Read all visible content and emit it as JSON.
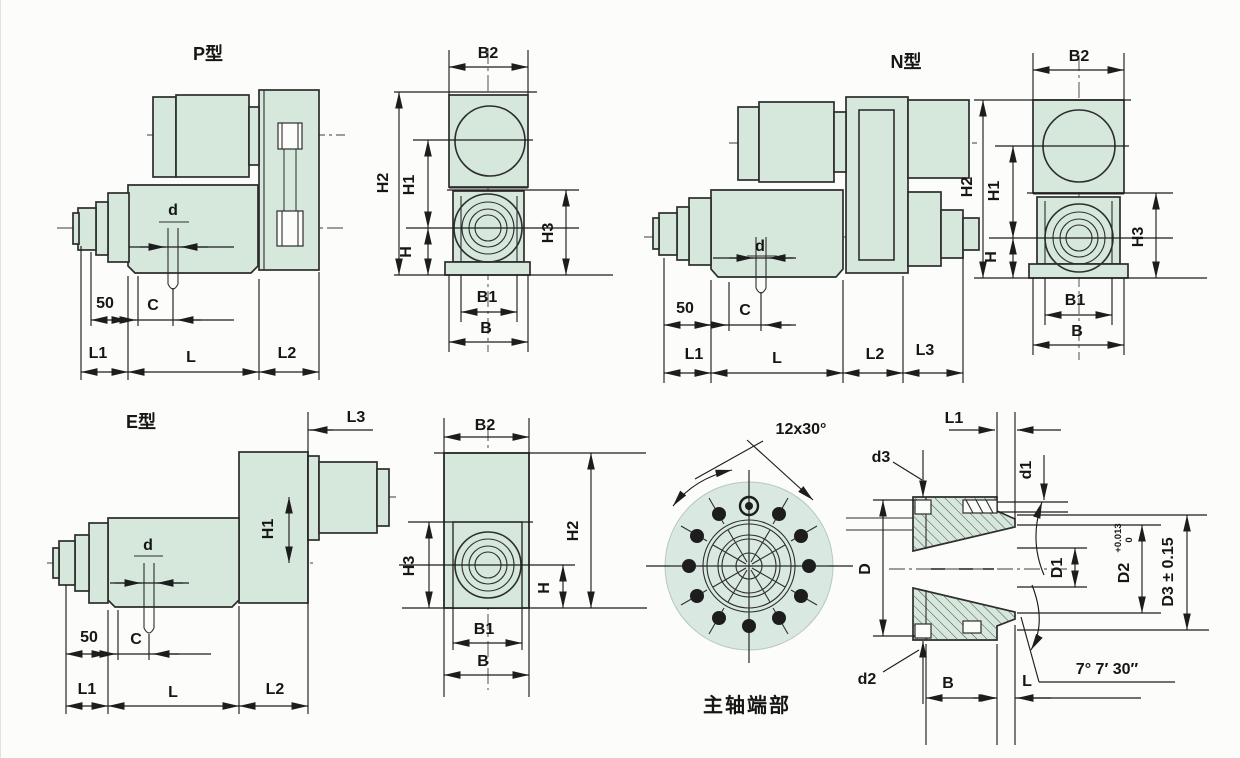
{
  "colors": {
    "part_fill": "#d6e7dc",
    "disc_fill": "#d9e9e1",
    "line": "#2d2d2d",
    "background": "#fcfcfa"
  },
  "views": {
    "p_side": {
      "title": "P型",
      "dims": {
        "d": "d",
        "fifty": "50",
        "c": "C",
        "l1": "L1",
        "l": "L",
        "l2": "L2"
      }
    },
    "p_front": {
      "dims": {
        "b2": "B2",
        "h2": "H2",
        "h1": "H1",
        "h": "H",
        "h3": "H3",
        "b1": "B1",
        "b": "B"
      }
    },
    "n_side": {
      "title": "N型",
      "dims": {
        "d": "d",
        "fifty": "50",
        "c": "C",
        "l1": "L1",
        "l": "L",
        "l2": "L2",
        "l3": "L3"
      }
    },
    "n_front": {
      "dims": {
        "b2": "B2",
        "h2": "H2",
        "h1": "H1",
        "h": "H",
        "h3": "H3",
        "b1": "B1",
        "b": "B"
      }
    },
    "e_side": {
      "title": "E型",
      "dims": {
        "d": "d",
        "fifty": "50",
        "c": "C",
        "l1": "L1",
        "l": "L",
        "l2": "L2",
        "l3": "L3",
        "h1": "H1"
      }
    },
    "e_front": {
      "dims": {
        "b2": "B2",
        "h3": "H3",
        "h": "H",
        "h2": "H2",
        "b1": "B1",
        "b": "B"
      }
    },
    "spindle_end": {
      "caption": "主轴端部",
      "pattern_note": "12x30°"
    },
    "section": {
      "dims": {
        "l1": "L1",
        "d1": "d1",
        "d3": "d3",
        "d2": "d2",
        "D": "D",
        "D1": "D1",
        "D2": "D2",
        "D2_tol_up": "+0.013",
        "D2_tol_dn": "0",
        "D3": "D3 ± 0.15",
        "B": "B",
        "L": "L",
        "taper": "7° 7′ 30″"
      }
    }
  }
}
